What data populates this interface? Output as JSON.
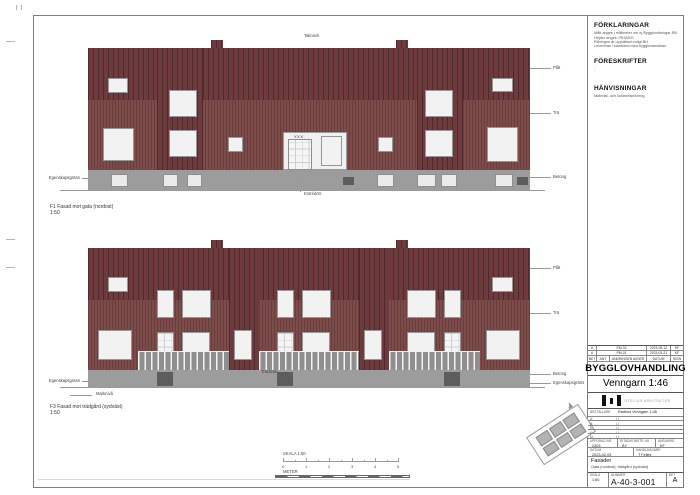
{
  "notes": {
    "forklaringar": {
      "title": "FÖRKLARINGAR",
      "lines": [
        "Mått anges i millimeter om ej Bygglovritningar RB",
        "Höjder anges i RH2000",
        "Ritningen är upprättad enligt BH",
        "Levereras i samband med bygglovansökan"
      ]
    },
    "foreskrifter": {
      "title": "FÖRESKRIFTER",
      "lines": [
        "-"
      ]
    },
    "hanvisningar": {
      "title": "HÄNVISNINGAR",
      "lines": [
        "Material- och kulörbeskrivning"
      ]
    }
  },
  "titleblock": {
    "revisions": [
      {
        "bet": "A",
        "ant": "PM-02",
        "datum": "2023-05-12",
        "sign": "KF"
      },
      {
        "bet": "A",
        "ant": "PM-01",
        "datum": "2023-03-21",
        "sign": "KF"
      }
    ],
    "revision_header": {
      "bet": "BET",
      "ant": "ANT",
      "avser": "ÄNDRINGEN AVSER",
      "datum": "DATUM",
      "sign": "SIGN"
    },
    "status": "BYGGLOVHANDLING",
    "project": "Venngarn 1:46",
    "firm": "OTELIUS ARKITEKTER",
    "info_rows": [
      {
        "label": "BESTÄLLARE",
        "value": "Radhus Venngarn 1:46"
      },
      {
        "label": "A:",
        "value": "(-)"
      },
      {
        "label": "B:",
        "value": "(-)"
      },
      {
        "label": "E:",
        "value": "(-)"
      },
      {
        "label": "K:",
        "value": "(-)"
      },
      {
        "label": "M:",
        "value": "(-)"
      }
    ],
    "uppdrag_label": "UPPDRAG.NR",
    "uppdrag": "2303",
    "ritad_label": "RITAD/KONSTR. AV",
    "ritad": "ÄY",
    "ansvarig_label": "ANSVARIG",
    "ansvarig": "KF",
    "datum_label": "DATUM",
    "datum": "2023-02-03",
    "handlaggare_label": "HANDLÄGGARE",
    "handlaggare": "T Felles",
    "content_title": "Fasader",
    "content_sub": "Gata (nordost), trädgård (sydväst)",
    "skala_label": "SKALA",
    "skala": "1:50",
    "nummer_label": "NUMMER",
    "nummer": "A-40-3-001",
    "bet_label": "BET",
    "bet": "A"
  },
  "scalebar": {
    "title": "SKALA 1:50",
    "unit": "METER",
    "ticks": [
      "0",
      "1",
      "2",
      "3",
      "4",
      "5"
    ]
  },
  "colors": {
    "wall": "#7d4b49",
    "gable": "#6d3a3e",
    "base": "#9c9c9c",
    "window": "#f2f2f2"
  },
  "elevations": {
    "f1": {
      "code": "F1",
      "title": "Fasad mot gata (nordost)",
      "scale": "1:50",
      "label_y": 205,
      "x": 88,
      "y": 48,
      "w": 442,
      "wall_h": 122,
      "base_h": 20,
      "gable_h": 52,
      "ground_y": 190,
      "towers": [
        [
          157,
          46
        ],
        [
          417,
          46
        ]
      ],
      "chimneys": [
        [
          211,
          12
        ],
        [
          396,
          12
        ]
      ],
      "entrance": {
        "x": 283,
        "y": 132,
        "w": 64,
        "h": 38,
        "sign": "XXX"
      },
      "windows": [
        [
          108,
          78,
          20,
          15
        ],
        [
          103,
          128,
          31,
          33
        ],
        [
          169,
          90,
          28,
          27
        ],
        [
          169,
          130,
          28,
          27
        ],
        [
          228,
          137,
          15,
          15
        ],
        [
          378,
          137,
          15,
          15
        ],
        [
          425,
          90,
          28,
          27
        ],
        [
          425,
          130,
          28,
          27
        ],
        [
          487,
          127,
          31,
          35
        ],
        [
          492,
          78,
          21,
          14
        ]
      ],
      "basement_windows": [
        [
          111,
          174,
          17,
          13
        ],
        [
          163,
          174,
          15,
          13
        ],
        [
          187,
          174,
          15,
          13
        ],
        [
          377,
          174,
          17,
          13
        ],
        [
          417,
          174,
          19,
          13
        ],
        [
          441,
          174,
          16,
          13
        ],
        [
          495,
          174,
          18,
          13
        ]
      ],
      "dark_boxes": [
        [
          343,
          177,
          11,
          8
        ],
        [
          517,
          177,
          11,
          8
        ]
      ],
      "materials": [
        {
          "label": "Plåt",
          "y": 68
        },
        {
          "label": "Trä",
          "y": 113
        },
        {
          "label": "Betong",
          "y": 177
        }
      ],
      "left_note": {
        "text": "Egenskapsgräns",
        "y": 178
      },
      "leaders": [
        [
          300,
          171,
          1,
          21
        ]
      ],
      "notes": [
        {
          "text": "Entrédörr",
          "x": 304,
          "y": 192
        },
        {
          "text": "Taknock",
          "x": 304,
          "y": 34
        }
      ]
    },
    "f3": {
      "code": "F3",
      "title": "Fasad mot trädgård (sydväst)",
      "scale": "1:50",
      "label_y": 405,
      "x": 88,
      "y": 248,
      "w": 442,
      "wall_h": 122,
      "base_h": 17,
      "gable_h": 52,
      "ground_y": 387,
      "towers": [
        [
          229,
          30
        ],
        [
          359,
          30
        ]
      ],
      "chimneys": [
        [
          211,
          12
        ],
        [
          396,
          12
        ]
      ],
      "railing_y": 351,
      "railing_h": 19,
      "railings": [
        [
          138,
          91
        ],
        [
          259,
          100
        ],
        [
          389,
          91
        ]
      ],
      "windows": [
        [
          108,
          277,
          20,
          15
        ],
        [
          492,
          277,
          21,
          15
        ],
        [
          157,
          290,
          17,
          28
        ],
        [
          182,
          290,
          29,
          28
        ],
        [
          277,
          290,
          17,
          28
        ],
        [
          302,
          290,
          29,
          28
        ],
        [
          407,
          290,
          29,
          28
        ],
        [
          444,
          290,
          17,
          28
        ],
        [
          98,
          330,
          34,
          30
        ],
        [
          486,
          330,
          34,
          30
        ],
        [
          234,
          330,
          18,
          30
        ],
        [
          364,
          330,
          18,
          30
        ],
        [
          182,
          332,
          28,
          26
        ],
        [
          302,
          332,
          28,
          26
        ],
        [
          407,
          332,
          28,
          26
        ]
      ],
      "doors": [
        [
          157,
          332,
          17,
          36
        ],
        [
          277,
          332,
          17,
          36
        ],
        [
          444,
          332,
          17,
          36
        ]
      ],
      "base_doors": [
        [
          157,
          372,
          16,
          14
        ],
        [
          277,
          372,
          16,
          14
        ],
        [
          444,
          372,
          16,
          14
        ]
      ],
      "materials": [
        {
          "label": "Plåt",
          "y": 268
        },
        {
          "label": "Trä",
          "y": 313
        },
        {
          "label": "Betong",
          "y": 374
        },
        {
          "label": "Egenskapsgräns",
          "y": 383
        }
      ],
      "left_note": {
        "text": "Egenskapsgräns",
        "y": 381
      },
      "leaders": [
        [
          232,
          373,
          27,
          1
        ],
        [
          70,
          395,
          22,
          1
        ]
      ],
      "notes": [
        {
          "text": "Träräcke",
          "x": 261,
          "y": 370
        },
        {
          "text": "Marknivå",
          "x": 96,
          "y": 392
        }
      ]
    }
  }
}
